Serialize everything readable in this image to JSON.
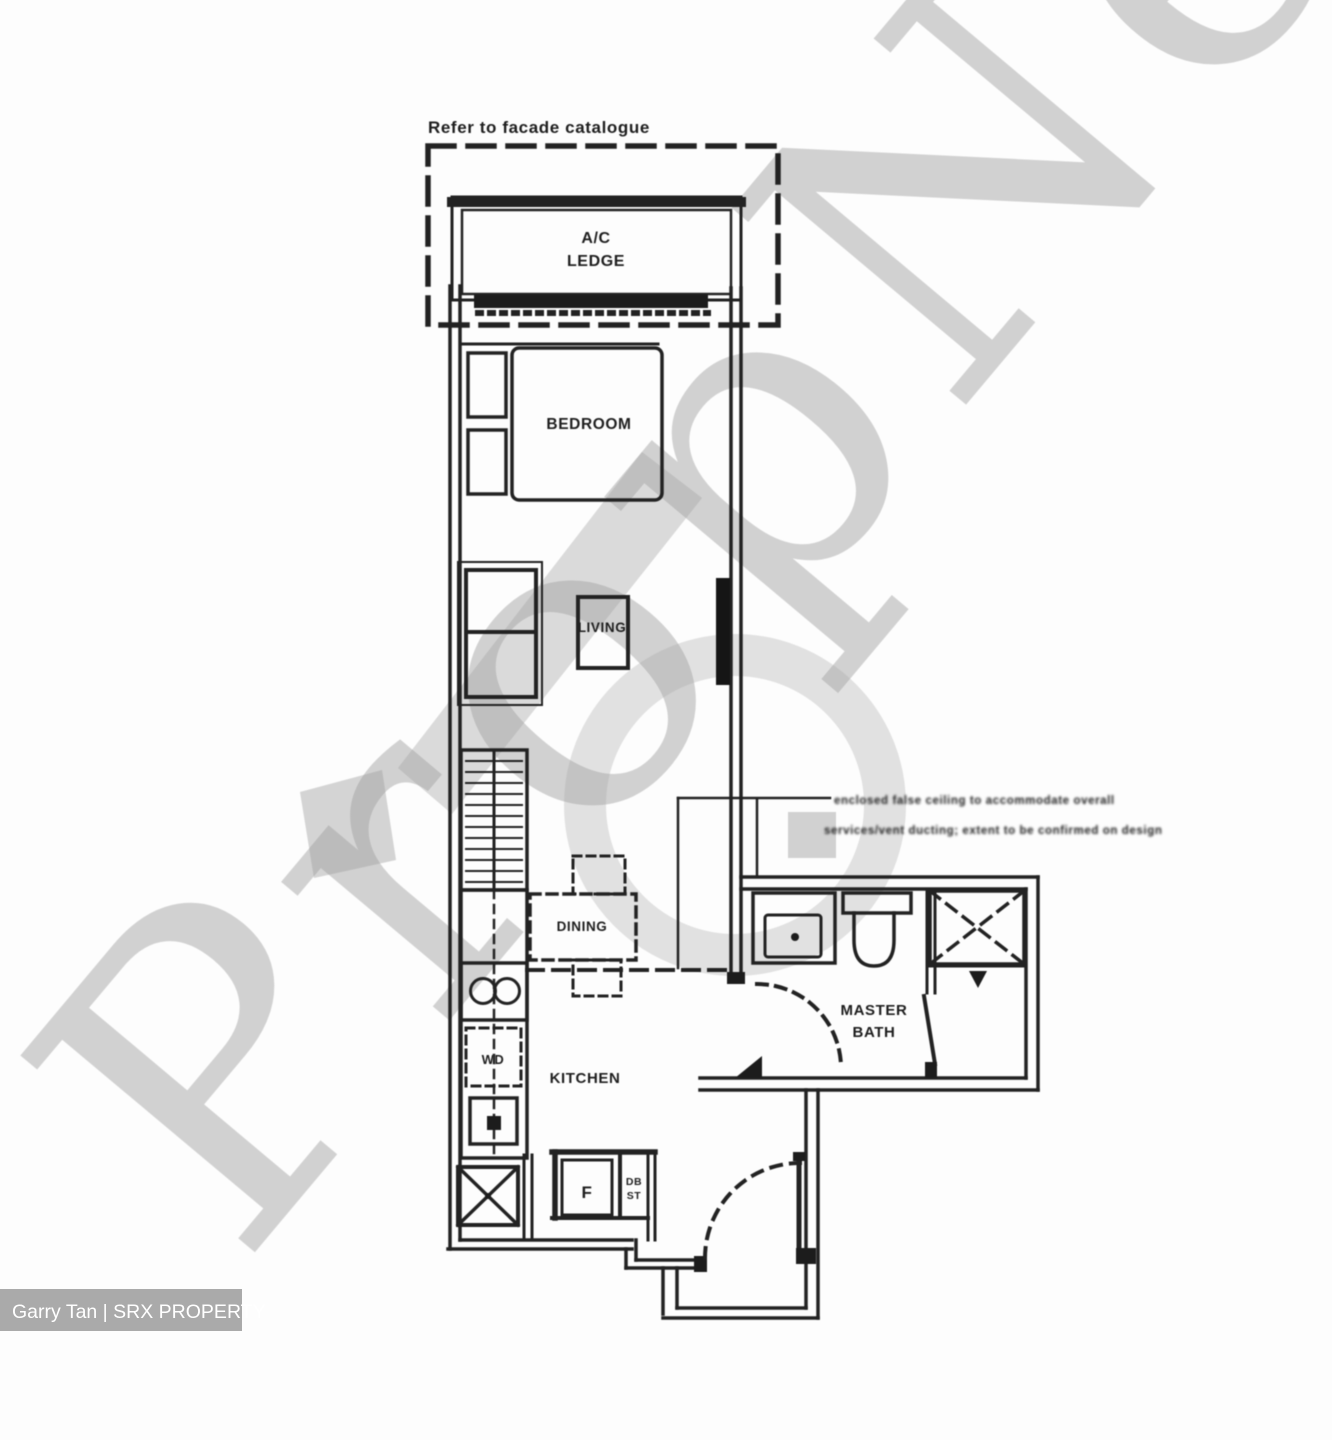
{
  "watermark": {
    "brand": "PropNex"
  },
  "credit": "Garry Tan | SRX PROPERTY",
  "notes": {
    "facade": "Refer to facade catalogue",
    "annotation_line1": "enclosed false ceiling to accommodate overall",
    "annotation_line2": "services/vent ducting; extent to be confirmed on design"
  },
  "labels": {
    "ac_ledge": [
      "A/C",
      "LEDGE"
    ],
    "bedroom": "BEDROOM",
    "living": "LIVING",
    "dining": "DINING",
    "kitchen": "KITCHEN",
    "master_bath": [
      "MASTER",
      "BATH"
    ],
    "washer_dryer": "WD",
    "fridge": "F",
    "db": "DB",
    "st": "ST"
  },
  "colors": {
    "line": "#1f1f1f",
    "watermark": "#a6a6a6",
    "credit_bg": "#9b9b9b",
    "credit_text": "#ffffff"
  }
}
